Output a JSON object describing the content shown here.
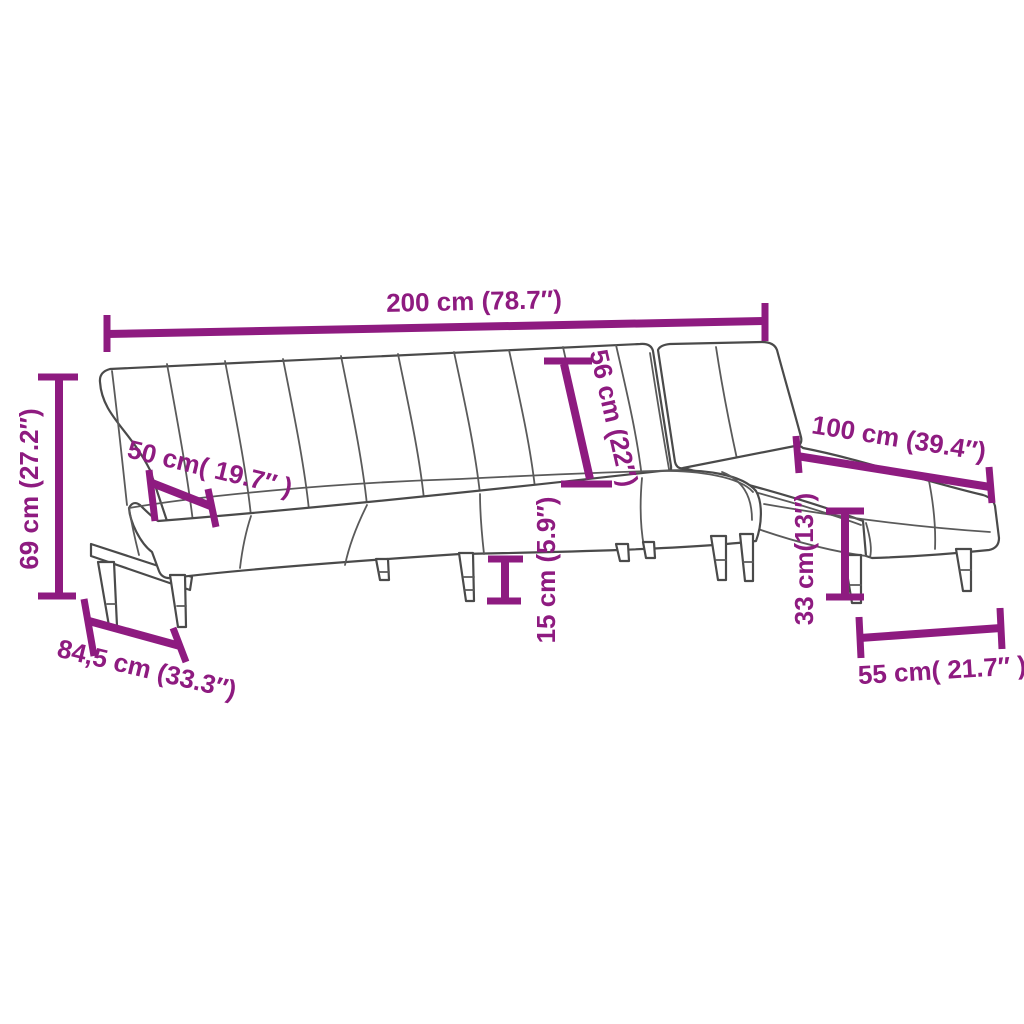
{
  "diagram": {
    "subject": "L-shaped sofa bed line drawing with dimension annotations",
    "colors": {
      "background": "#ffffff",
      "drawing_stroke": "#4a4a4a",
      "dimension_accent": "#8e1b80"
    },
    "dimensions": {
      "total_width": {
        "label": "200 cm (78.7″)",
        "cm": "200",
        "inches": "78.7"
      },
      "total_height": {
        "label": "69 cm (27.2″)",
        "cm": "69",
        "inches": "27.2"
      },
      "seat_depth": {
        "label": "50 cm( 19.7″ )",
        "cm": "50",
        "inches": "19.7"
      },
      "backrest_height": {
        "label": "56 cm (22″)",
        "cm": "56",
        "inches": "22"
      },
      "chaise_length": {
        "label": "100 cm (39.4″)",
        "cm": "100",
        "inches": "39.4"
      },
      "seat_clearance": {
        "label": "15 cm (5.9″)",
        "cm": "15",
        "inches": "5.9"
      },
      "base_depth": {
        "label": "84,5 cm (33.3″)",
        "cm": "84,5",
        "inches": "33.3"
      },
      "chaise_clearance": {
        "label": "33 cm(13″)",
        "cm": "33",
        "inches": "13"
      },
      "chaise_width": {
        "label": "55 cm( 21.7″ )",
        "cm": "55",
        "inches": "21.7"
      }
    }
  }
}
